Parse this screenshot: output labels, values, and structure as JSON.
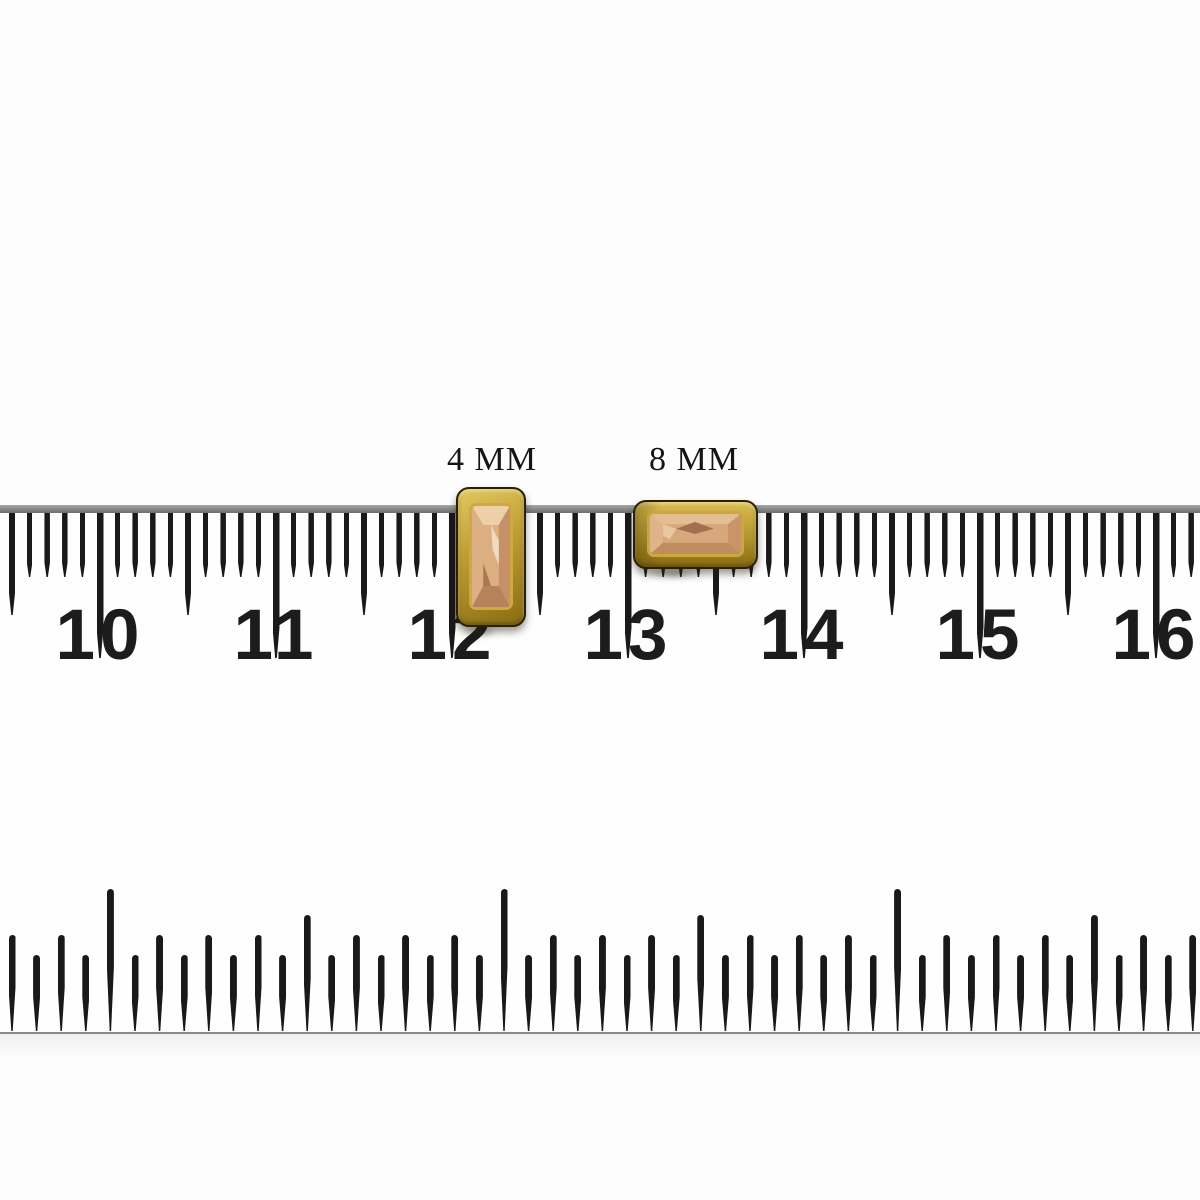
{
  "page": {
    "background": "#fdfdfd"
  },
  "ruler": {
    "top_scale": {
      "type": "centimeter-millimeter",
      "numbers": [
        "10",
        "11",
        "12",
        "13",
        "14",
        "15",
        "16"
      ],
      "number_color": "#1c1c1c",
      "tick_color": "#191919",
      "edge_color_top": "#a8a8a8",
      "edge_color_bottom": "#6c6c6c",
      "edge_y": 505,
      "edge_h": 8,
      "anchor_x": 100,
      "mm_pitch_px": 17.6,
      "tick_index_min": -5,
      "tick_index_max": 62,
      "mm_len": 71,
      "half_cm_len": 109,
      "cm_len": 152
    },
    "bottom_scale": {
      "type": "inch-sixteenths",
      "tick_color": "#191919",
      "baseline_color": "#8a8a8a",
      "baseline_y": 1032,
      "start_x": 12,
      "pitch_px": 24.6,
      "count": 49,
      "len_inch": 142,
      "len_half": 116,
      "len_eighth": 96,
      "len_sixteenth": 76
    }
  },
  "items": [
    {
      "label": "4 MM",
      "shape": "vertical-baguette-charm",
      "x": 456,
      "y": 487,
      "w": 70,
      "h": 140,
      "label_x": 492,
      "label_y": 443,
      "gold_light": "#e3c75f",
      "gold_mid": "#bb9c33",
      "gold_dark": "#8a6c12",
      "rim": "#cfa93f",
      "stone": {
        "base": "#d4a478",
        "facet_top": "#ecd0a8",
        "facet_left": "#dcb084",
        "facet_right": "#c69068",
        "facet_bottom": "#b5825a",
        "table": "#ddae80",
        "highlight": "#f4e6ce",
        "shadow_facet": "#a97a50"
      }
    },
    {
      "label": "8 MM",
      "shape": "horizontal-baguette-charm",
      "x": 633,
      "y": 500,
      "w": 125,
      "h": 69,
      "label_x": 694,
      "label_y": 443,
      "gold_light": "#d9bc52",
      "gold_mid": "#b3942e",
      "gold_dark": "#8a6c12",
      "rim": "#c9a83c",
      "stone": {
        "base": "#d2a077",
        "facet_top": "#e4bd92",
        "facet_left": "#e0b48a",
        "facet_right": "#c89468",
        "facet_bottom": "#bf8c62",
        "table": "#d6a87c",
        "highlight": "#edd2ae",
        "shadow_facet": "#a27050"
      }
    }
  ]
}
